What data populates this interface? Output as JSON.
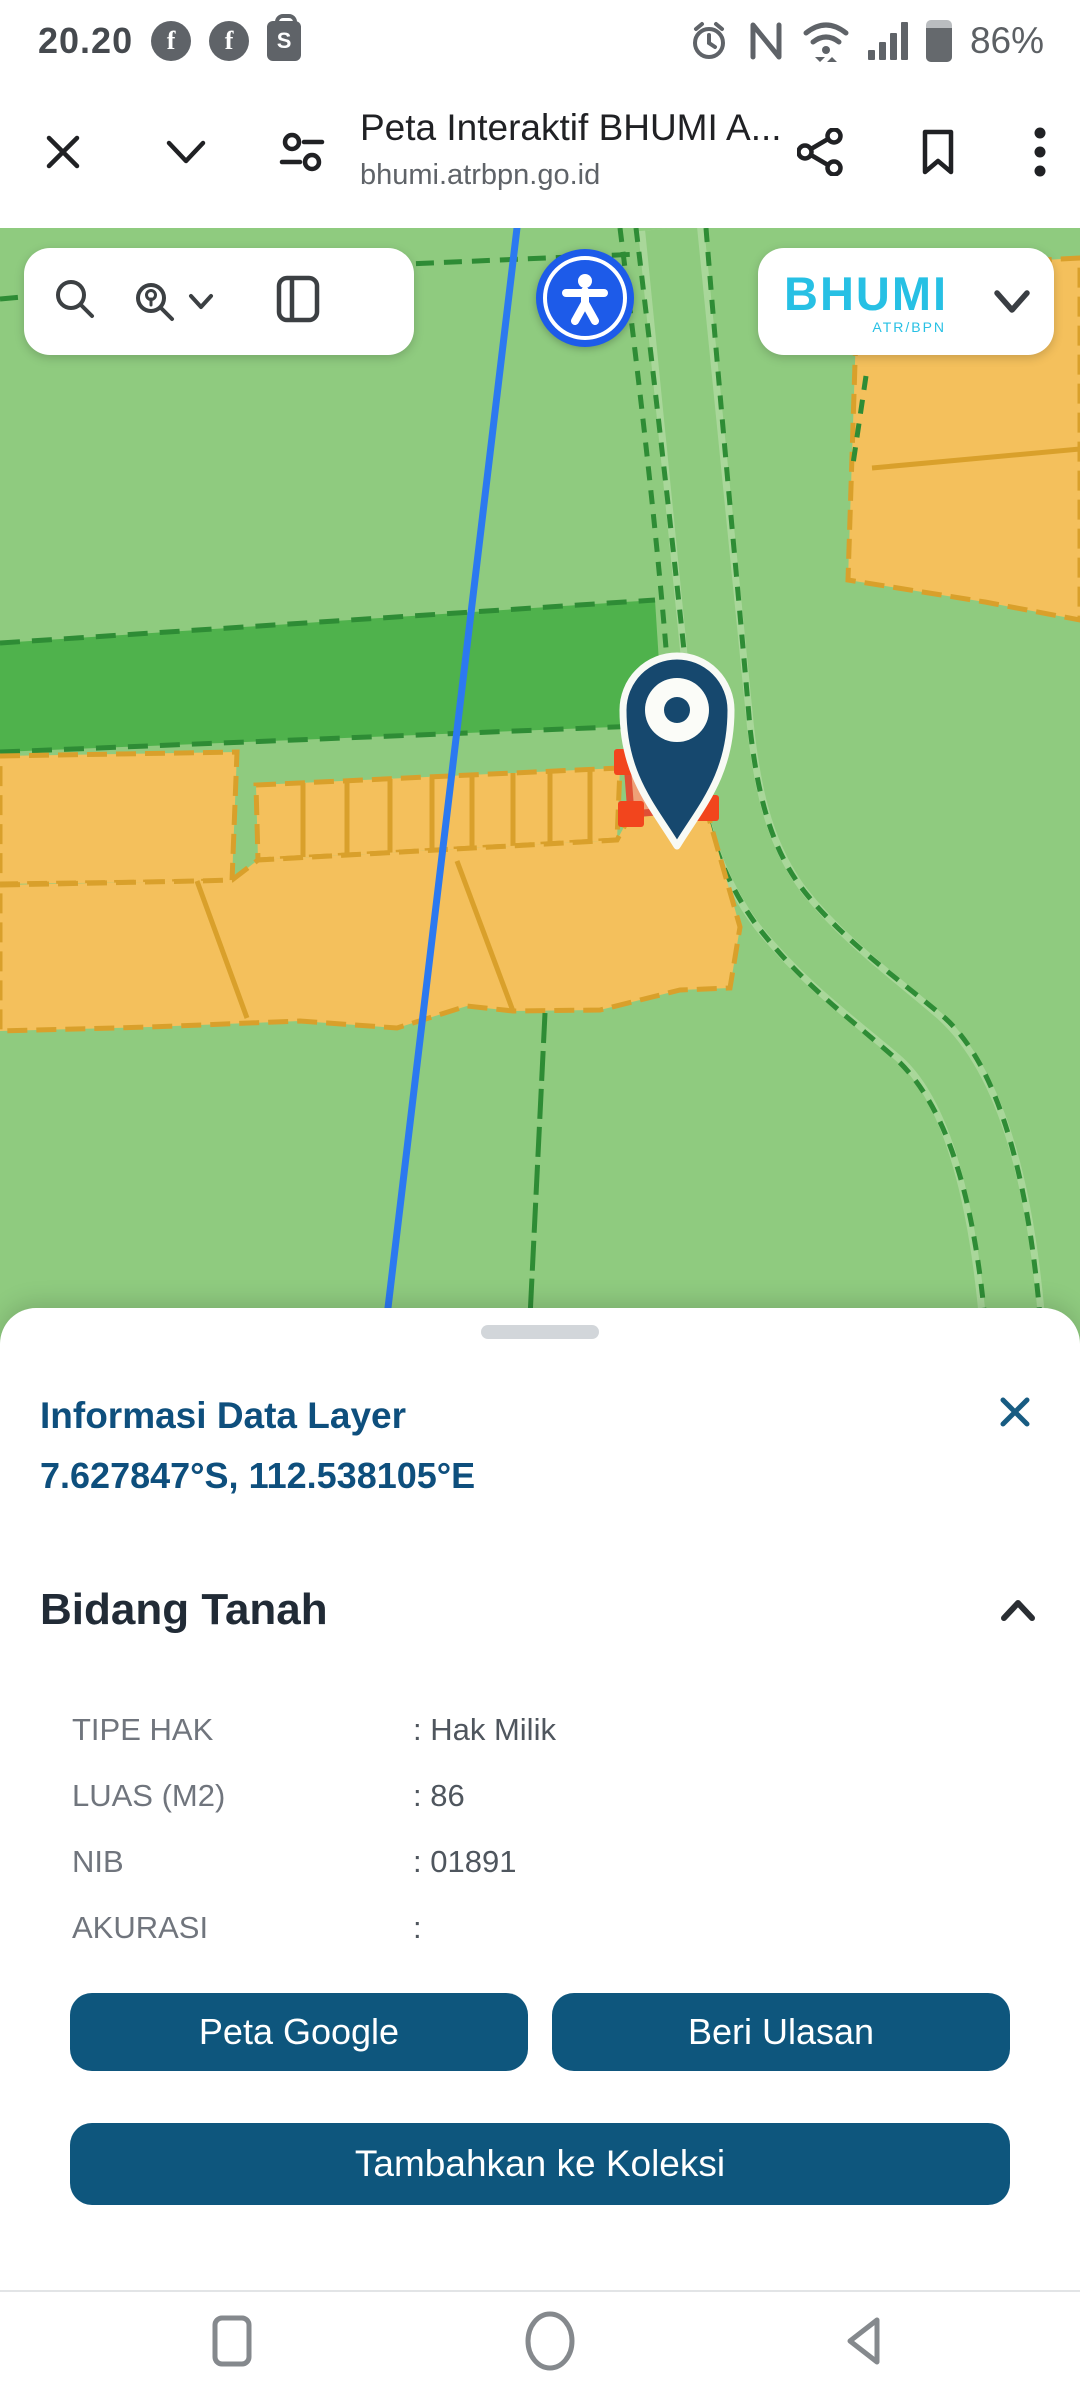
{
  "status_bar": {
    "time": "20.20",
    "battery_percent": "86%",
    "notification_icons": [
      "facebook-icon",
      "facebook-icon",
      "shopee-bag-icon"
    ],
    "system_icons": [
      "alarm-icon",
      "nfc-icon",
      "wifi-icon",
      "signal-icon",
      "battery-icon"
    ]
  },
  "browser": {
    "title": "Peta Interaktif BHUMI A...",
    "url": "bhumi.atrbpn.go.id",
    "icons": [
      "close-icon",
      "chevron-down-icon",
      "tune-icon",
      "share-icon",
      "bookmark-icon",
      "overflow-menu-icon"
    ]
  },
  "map": {
    "logo_text": "BHUMI",
    "logo_subtext": "ATR/BPN",
    "control_icons": [
      "search-icon",
      "search-place-icon",
      "chevron-down-icon",
      "side-panel-icon",
      "accessibility-icon"
    ],
    "colors": {
      "map_background": "#8fcb7f",
      "field_dark_green": "#4fb24c",
      "parcel_orange": "#f4c05c",
      "parcel_border": "#d9a02b",
      "selected_parcel_fill": "#efa077",
      "selected_parcel_border": "#df4f35",
      "selection_handle_red": "#f2451d",
      "boundary_blue_line": "#2c79f0",
      "road_green_line": "#2e8c35",
      "pin_navy": "#16486e",
      "accessibility_blue": "#1d5be9",
      "logo_cyan": "#27c0e4"
    }
  },
  "sheet": {
    "title": "Informasi Data Layer",
    "coordinates": "7.627847°S, 112.538105°E",
    "section_title": "Bidang Tanah",
    "rows": [
      {
        "label": "TIPE HAK",
        "value": ": Hak Milik"
      },
      {
        "label": "LUAS (M2)",
        "value": ": 86"
      },
      {
        "label": "NIB",
        "value": ": 01891"
      },
      {
        "label": "AKURASI",
        "value": ":"
      }
    ],
    "buttons": {
      "google": "Peta Google",
      "review": "Beri Ulasan",
      "collection": "Tambahkan ke Koleksi"
    }
  },
  "nav_bar": {
    "icons": [
      "recents-icon",
      "home-icon",
      "back-icon"
    ]
  }
}
